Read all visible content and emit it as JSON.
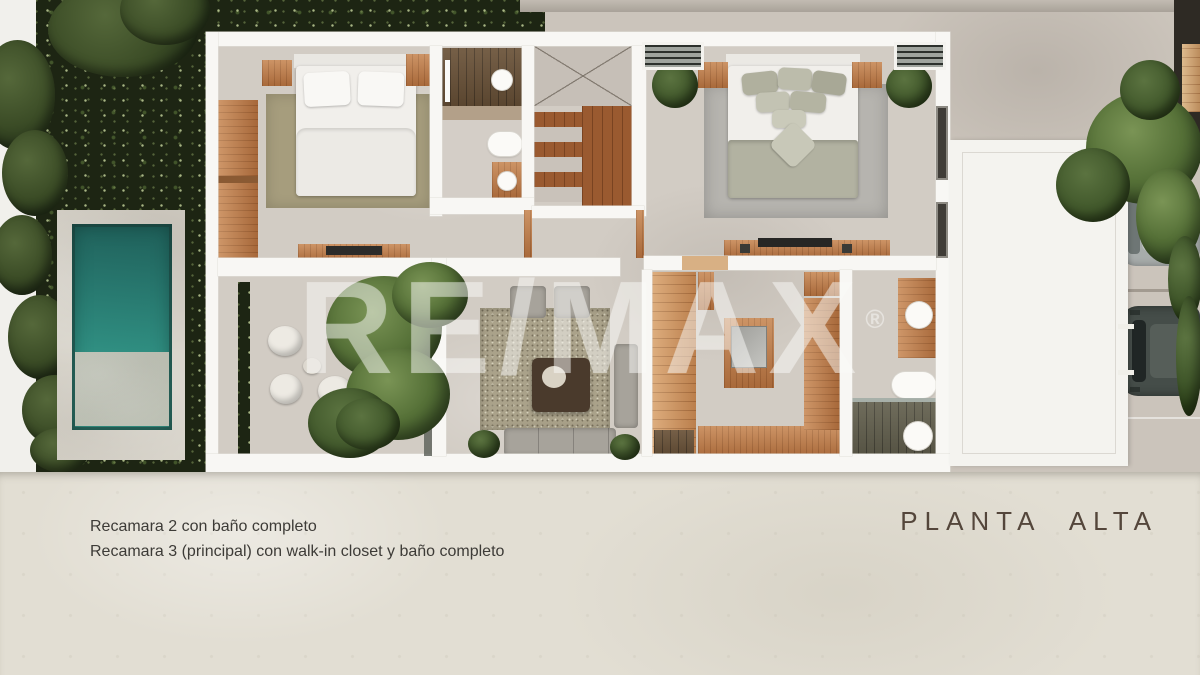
{
  "watermark": {
    "brand": "RE/MAX",
    "registered_mark": "®"
  },
  "footer": {
    "caption_line1": "Recamara 2 con baño completo",
    "caption_line2": "Recamara 3 (principal) con walk-in closet y baño completo",
    "plan_title": "PLANTA ALTA"
  },
  "colors": {
    "caption_text": "#3d3b37",
    "plan_title_text": "#54463b",
    "watermark_text": "rgba(250,250,248,0.42)",
    "pool_water": "#2f8d80",
    "vegetation_dark": "#1d2513",
    "wood_accent": "#bc7a48",
    "concrete_floor": "#cbc4bb",
    "footer_background": "#e2ded3"
  }
}
